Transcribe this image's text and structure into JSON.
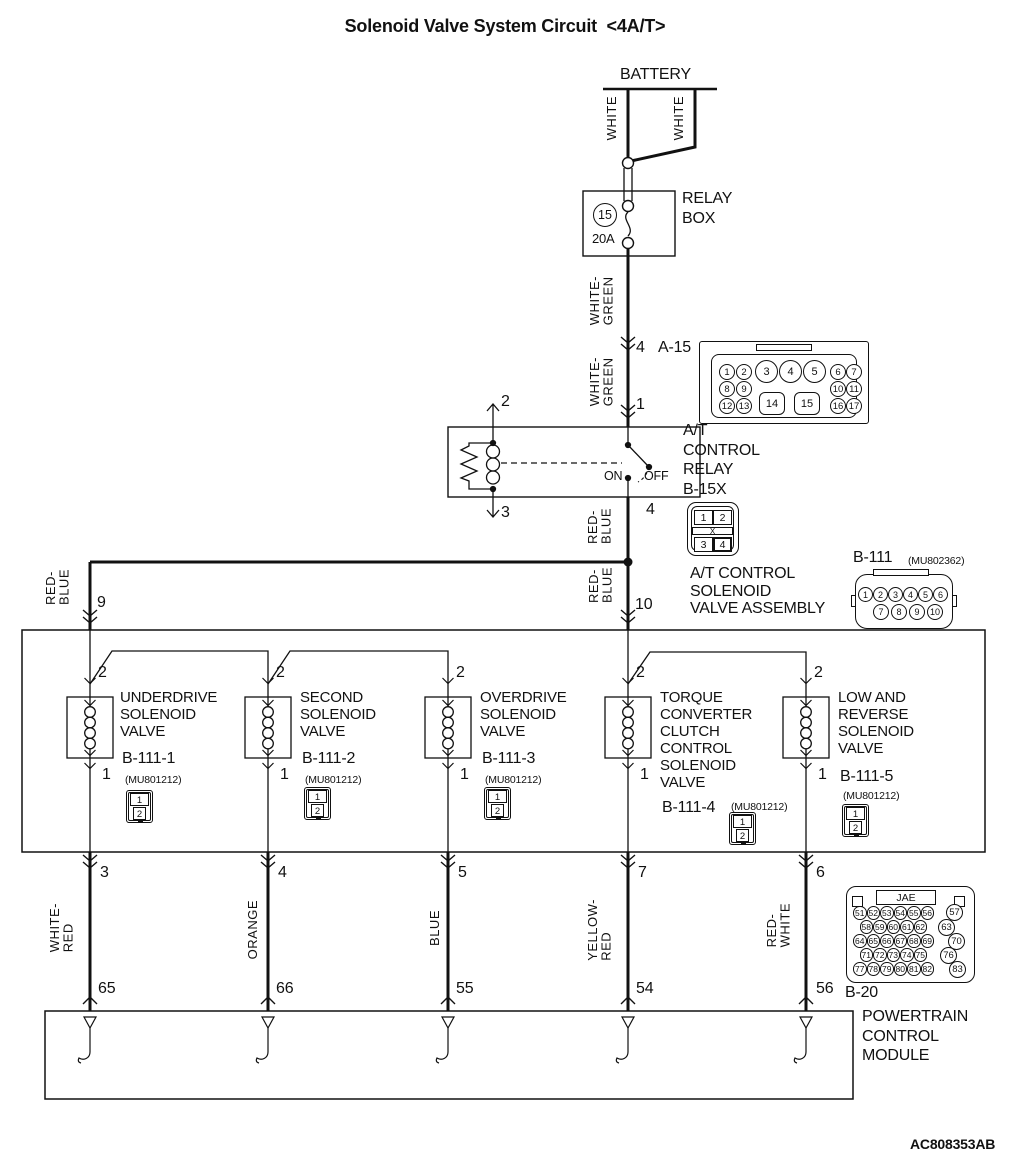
{
  "title": "Solenoid Valve System Circuit  <4A/T>",
  "doc_code": "AC808353AB",
  "battery": {
    "label": "BATTERY"
  },
  "relay_box": {
    "label": "RELAY\nBOX",
    "fuse_no": "15",
    "fuse_rating": "20A"
  },
  "wire_colors": {
    "white": "WHITE",
    "white_green": "WHITE-\nGREEN",
    "red_blue": "RED-\nBLUE",
    "white_red": "WHITE-\nRED",
    "orange": "ORANGE",
    "blue": "BLUE",
    "yellow_red": "YELLOW-\nRED",
    "red_white": "RED-\nWHITE"
  },
  "a15": {
    "wire_pin": "4",
    "name": "A-15",
    "pins": [
      "1",
      "2",
      "3",
      "4",
      "5",
      "6",
      "7",
      "8",
      "9",
      "10",
      "11",
      "12",
      "13",
      "14",
      "15",
      "16",
      "17"
    ]
  },
  "at_relay": {
    "label": "A/T\nCONTROL\nRELAY\nB-15X",
    "pin_in": "1",
    "pin_coil_top": "2",
    "pin_coil_bottom": "3",
    "pin_out": "4",
    "on": "ON",
    "off": "OFF"
  },
  "b15x": {
    "pins": [
      "1",
      "2",
      "3",
      "4"
    ],
    "center": "X"
  },
  "junction": {
    "pin_left": "9",
    "pin_right": "10"
  },
  "assembly": {
    "label": "A/T CONTROL\nSOLENOID\nVALVE ASSEMBLY",
    "connector": "B-111",
    "part": "(MU802362)"
  },
  "b111": {
    "row1": [
      "1",
      "2",
      "3",
      "4",
      "5",
      "6"
    ],
    "row2": [
      "7",
      "8",
      "9",
      "10"
    ]
  },
  "mini_connector": {
    "top": "1",
    "bottom": "2"
  },
  "valves": [
    {
      "name": "UNDERDRIVE\nSOLENOID\nVALVE",
      "code": "B-111-1",
      "part": "(MU801212)",
      "pin_top": "2",
      "pin_bottom": "1",
      "out_pin": "3",
      "pcm_pin": "65"
    },
    {
      "name": "SECOND\nSOLENOID\nVALVE",
      "code": "B-111-2",
      "part": "(MU801212)",
      "pin_top": "2",
      "pin_bottom": "1",
      "out_pin": "4",
      "pcm_pin": "66"
    },
    {
      "name": "OVERDRIVE\nSOLENOID\nVALVE",
      "code": "B-111-3",
      "part": "(MU801212)",
      "pin_top": "2",
      "pin_bottom": "1",
      "out_pin": "5",
      "pcm_pin": "55"
    },
    {
      "name": "TORQUE\nCONVERTER\nCLUTCH\nCONTROL\nSOLENOID\nVALVE",
      "code": "B-111-4",
      "part": "(MU801212)",
      "pin_top": "2",
      "pin_bottom": "1",
      "out_pin": "7",
      "pcm_pin": "54"
    },
    {
      "name": "LOW AND\nREVERSE\nSOLENOID\nVALVE",
      "code": "B-111-5",
      "part": "(MU801212)",
      "pin_top": "2",
      "pin_bottom": "1",
      "out_pin": "6",
      "pcm_pin": "56"
    }
  ],
  "b20": {
    "name": "B-20",
    "maker": "JAE",
    "rows": [
      [
        "51",
        "52",
        "53",
        "54",
        "55",
        "56"
      ],
      [
        "58",
        "59",
        "60",
        "61",
        "62"
      ],
      [
        "64",
        "65",
        "66",
        "67",
        "68",
        "69"
      ],
      [
        "71",
        "72",
        "73",
        "74",
        "75"
      ],
      [
        "77",
        "78",
        "79",
        "80",
        "81",
        "82"
      ]
    ],
    "side": [
      "57",
      "63",
      "70",
      "76",
      "83"
    ]
  },
  "pcm": {
    "label": "POWERTRAIN\nCONTROL\nMODULE"
  }
}
